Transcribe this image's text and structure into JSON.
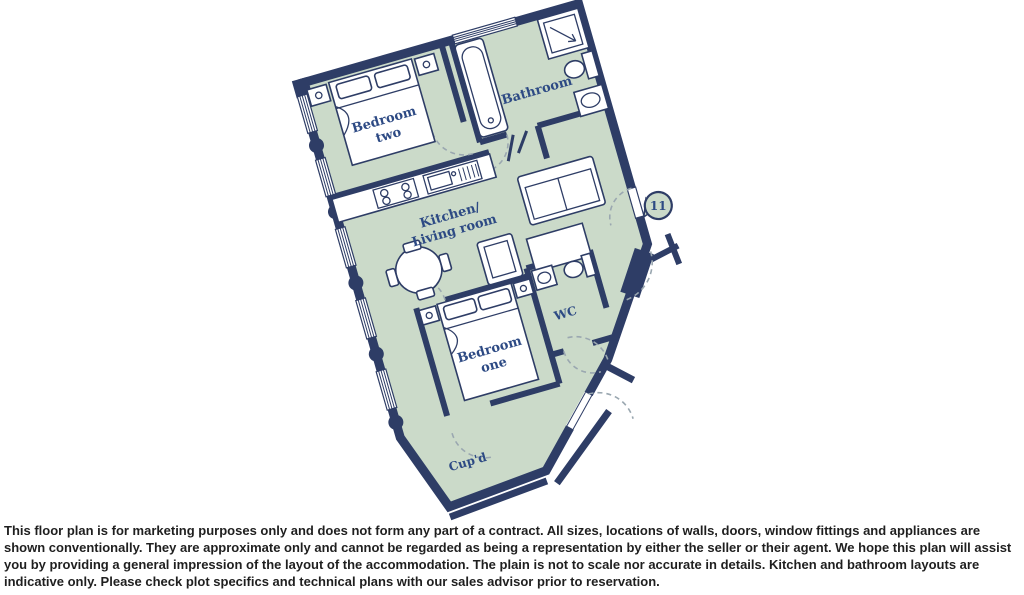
{
  "plan": {
    "rooms": {
      "bedroom_two": {
        "lines": [
          "Bedroom",
          "two"
        ]
      },
      "bathroom": {
        "lines": [
          "Bathroom"
        ]
      },
      "kitchen_living": {
        "lines": [
          "Kitchen/",
          "Living room"
        ]
      },
      "bedroom_one": {
        "lines": [
          "Bedroom",
          "one"
        ]
      },
      "wc": {
        "lines": [
          "WC"
        ]
      },
      "cupboard": {
        "lines": [
          "Cup'd"
        ]
      }
    },
    "plot_marker": "11",
    "colors": {
      "wall": "#2e3d66",
      "floor": "#cbdac9",
      "label": "#2d4a84",
      "door_swing": "#9aa7b0",
      "fixture_fill": "#ffffff"
    }
  },
  "disclaimer": "This floor plan is for marketing purposes only and does not form any part of a contract. All sizes, locations of walls, doors, window fittings and appliances are shown conventionally. They are approximate only and cannot be regarded as being a representation by either the seller or their agent. We hope this plan will assist you by providing a general impression of the layout of the accommodation. The plain is not to scale nor accurate in details. Kitchen and bathroom layouts are indicative only. Please check plot specifics and technical plans with our sales advisor prior to reservation."
}
